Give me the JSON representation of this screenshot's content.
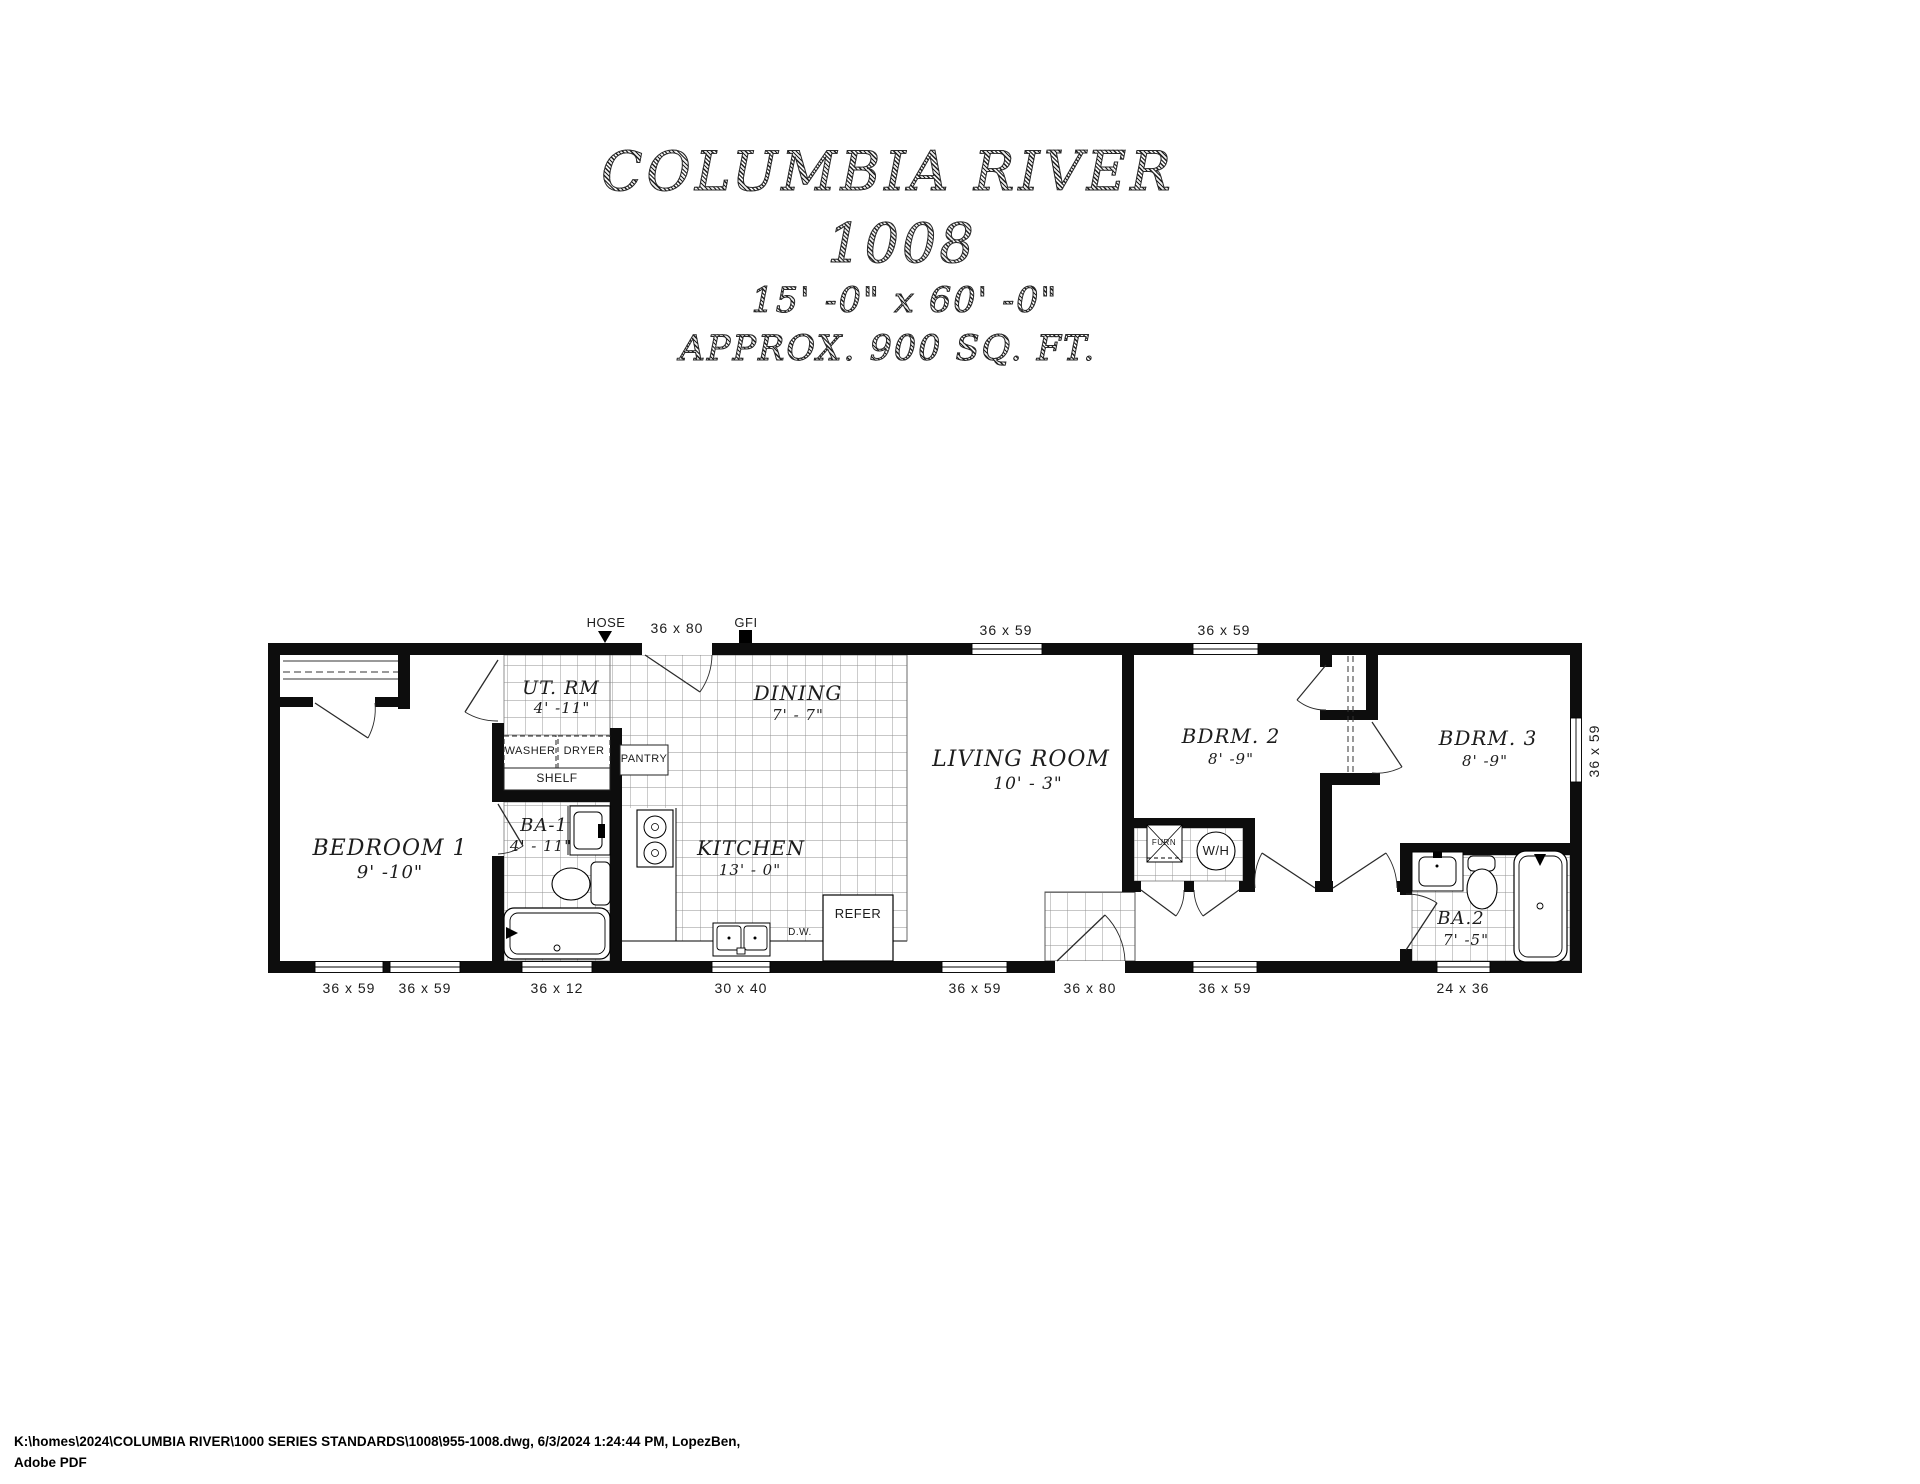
{
  "title": {
    "name": "COLUMBIA RIVER",
    "model": "1008",
    "dimensions": "15' -0\" x 60' -0\"",
    "area": "APPROX. 900 SQ. FT."
  },
  "rooms": {
    "bedroom1": {
      "label": "BEDROOM 1",
      "dim": "9' -10\""
    },
    "utility": {
      "label": "UT. RM",
      "dim": "4' -11\""
    },
    "dining": {
      "label": "DINING",
      "dim": "7' - 7\""
    },
    "kitchen": {
      "label": "KITCHEN",
      "dim": "13' - 0\""
    },
    "living": {
      "label": "LIVING ROOM",
      "dim": "10' - 3\""
    },
    "bdrm2": {
      "label": "BDRM. 2",
      "dim": "8' -9\""
    },
    "bdrm3": {
      "label": "BDRM. 3",
      "dim": "8' -9\""
    },
    "ba1": {
      "label": "BA-1",
      "dim": "4' - 11\""
    },
    "ba2": {
      "label": "BA.2",
      "dim": "7' -5\""
    }
  },
  "fixtures": {
    "washer": "WASHER",
    "dryer": "DRYER",
    "shelf": "SHELF",
    "pantry": "PANTRY",
    "refer": "REFER",
    "dishwasher": "D.W.",
    "furnace": "FURN",
    "water_heater": "W/H"
  },
  "markers": {
    "hose": "HOSE",
    "gfi": "GFI"
  },
  "openings": {
    "top": [
      "36 x 80",
      "36 x 59",
      "36 x 59"
    ],
    "bottom": [
      "36 x 59",
      "36 x 59",
      "36 x 12",
      "30 x 40",
      "36 x 59",
      "36 x 80",
      "36 x 59",
      "24 x 36"
    ],
    "right": [
      "36 x 59"
    ]
  },
  "footer": {
    "line1": "K:\\homes\\2024\\COLUMBIA RIVER\\1000 SERIES STANDARDS\\1008\\955-1008.dwg, 6/3/2024 1:24:44 PM, LopezBen,",
    "line2": "Adobe PDF"
  }
}
